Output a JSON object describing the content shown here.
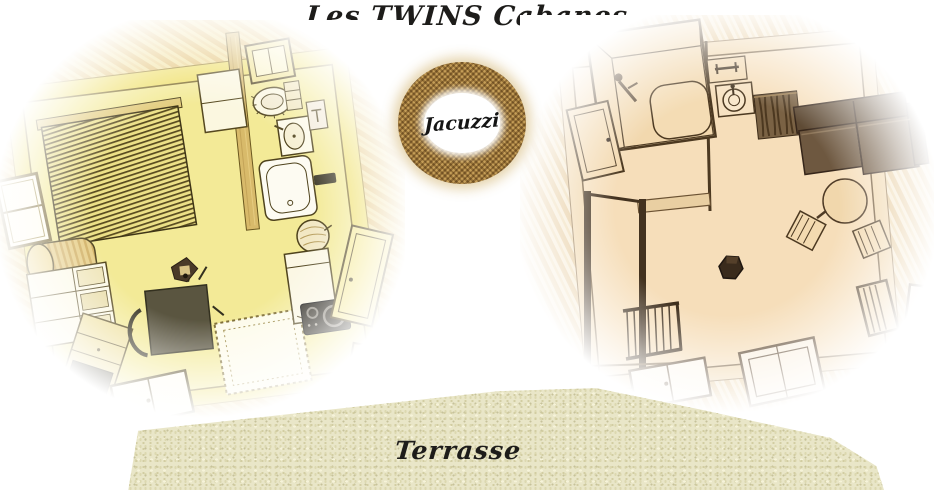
{
  "title": "Les TWINS Cabanes",
  "jacuzzi_badge": {
    "label": "Jacuzzi"
  },
  "terrace": {
    "label": "Terrasse"
  },
  "left_plan": {
    "name": "left cabin floor plan",
    "features": [
      "bed",
      "left-window",
      "bolster-cushion",
      "shelving-unit",
      "drawer-cabinet",
      "desk-and-chair",
      "plant",
      "rug",
      "bottom-window",
      "partition-wall",
      "wall-cabinet",
      "bathroom-window",
      "toilet",
      "washbasin",
      "mirror",
      "bathtub",
      "towel-sign",
      "water-heater",
      "kitchen-unit",
      "cooktop",
      "entry-door",
      "second-door"
    ]
  },
  "right_plan": {
    "name": "right cabin floor plan",
    "features": [
      "shower-cabin",
      "towel-shelf",
      "washbasin",
      "laundry-basket",
      "sofa",
      "round-rug",
      "floor-cushion",
      "floor-cushion",
      "wood-stove",
      "magazine-rack",
      "side-window",
      "side-window",
      "staircase",
      "railing",
      "floor-hatch-window",
      "floor-hatch-window",
      "entry-door",
      "partition-wall"
    ]
  },
  "colors": {
    "background": "#ffffff",
    "text": "#1d1c1a",
    "left_wall_yellow": "#efe06c",
    "left_floor_yellow": "#f3ea97",
    "left_wood_grain": "#e3c277",
    "left_line": "#4f431d",
    "right_wall_sepia": "#f1d7ac",
    "right_floor_sepia": "#f6deba",
    "right_line": "#4c3921",
    "sofa_brown": "#6e5840",
    "dark_appliance": "#201d15",
    "badge_burlap": "#c3a163",
    "badge_center": "#ffffff",
    "terrace_base": "#e9e6c8"
  }
}
